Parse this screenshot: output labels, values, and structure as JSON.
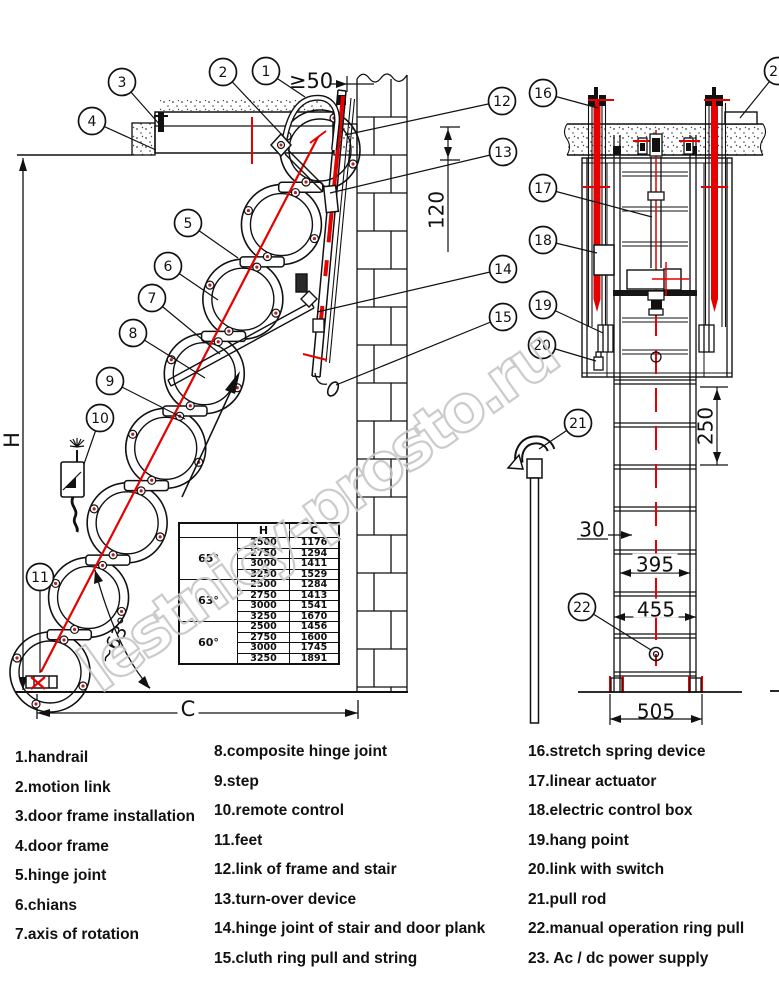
{
  "watermark": {
    "text": "lestnicy-prosto.ru"
  },
  "colors": {
    "red": "#e60000",
    "line": "#111111",
    "watermark": "#c6c6c6"
  },
  "table": {
    "headers": [
      "",
      "H",
      "C"
    ],
    "groups": [
      {
        "angle": "65°",
        "rows": [
          [
            "2500",
            "1176"
          ],
          [
            "2750",
            "1294"
          ],
          [
            "3000",
            "1411"
          ],
          [
            "3250",
            "1529"
          ]
        ]
      },
      {
        "angle": "63°",
        "rows": [
          [
            "2500",
            "1284"
          ],
          [
            "2750",
            "1413"
          ],
          [
            "3000",
            "1541"
          ],
          [
            "3250",
            "1670"
          ]
        ]
      },
      {
        "angle": "60°",
        "rows": [
          [
            "2500",
            "1456"
          ],
          [
            "2750",
            "1600"
          ],
          [
            "3000",
            "1745"
          ],
          [
            "3250",
            "1891"
          ]
        ]
      }
    ]
  },
  "legend": {
    "columns": [
      {
        "items": [
          "1.handrail",
          "2.motion link",
          "3.door frame installation",
          "4.door frame",
          "5.hinge joint",
          "6.chians",
          "7.axis of rotation"
        ]
      },
      {
        "items": [
          "8.composite hinge joint",
          "9.step",
          "10.remote control",
          "11.feet",
          "12.link of frame and stair",
          "13.turn-over device",
          "14.hinge joint of stair and door plank",
          "15.cluth ring pull and string"
        ]
      },
      {
        "items": [
          "16.stretch spring device",
          "17.linear actuator",
          "18.electric control box",
          "19.hang point",
          "20.link with switch",
          "21.pull rod",
          "22.manual operation ring pull",
          "23. Ac / dc power supply"
        ]
      }
    ]
  },
  "callouts": [
    {
      "n": "1",
      "cx": 266,
      "cy": 71,
      "tx": 305,
      "ty": 97
    },
    {
      "n": "2",
      "cx": 223,
      "cy": 72,
      "tx": 284,
      "ty": 137
    },
    {
      "n": "3",
      "cx": 122,
      "cy": 82,
      "tx": 161,
      "ty": 126
    },
    {
      "n": "4",
      "cx": 92,
      "cy": 121,
      "tx": 156,
      "ty": 150
    },
    {
      "n": "5",
      "cx": 188,
      "cy": 223,
      "tx": 238,
      "ty": 258
    },
    {
      "n": "6",
      "cx": 168,
      "cy": 266,
      "tx": 218,
      "ty": 300
    },
    {
      "n": "7",
      "cx": 152,
      "cy": 298,
      "tx": 220,
      "ty": 354
    },
    {
      "n": "8",
      "cx": 133,
      "cy": 333,
      "tx": 205,
      "ty": 378
    },
    {
      "n": "9",
      "cx": 110,
      "cy": 381,
      "tx": 185,
      "ty": 419
    },
    {
      "n": "10",
      "cx": 100,
      "cy": 418,
      "tx": 84,
      "ty": 464
    },
    {
      "n": "11",
      "cx": 40,
      "cy": 577,
      "tx": 40,
      "ty": 673
    },
    {
      "n": "12",
      "cx": 502,
      "cy": 101,
      "tx": 345,
      "ty": 135
    },
    {
      "n": "13",
      "cx": 503,
      "cy": 152,
      "tx": 330,
      "ty": 193
    },
    {
      "n": "14",
      "cx": 503,
      "cy": 269,
      "tx": 317,
      "ty": 312
    },
    {
      "n": "15",
      "cx": 503,
      "cy": 317,
      "tx": 336,
      "ty": 385
    },
    {
      "n": "16",
      "cx": 543,
      "cy": 93,
      "tx": 598,
      "ty": 108
    },
    {
      "n": "17",
      "cx": 543,
      "cy": 188,
      "tx": 652,
      "ty": 217
    },
    {
      "n": "18",
      "cx": 543,
      "cy": 240,
      "tx": 597,
      "ty": 253
    },
    {
      "n": "19",
      "cx": 543,
      "cy": 305,
      "tx": 603,
      "ty": 333
    },
    {
      "n": "20",
      "cx": 542,
      "cy": 345,
      "tx": 596,
      "ty": 361
    },
    {
      "n": "21",
      "cx": 578,
      "cy": 423,
      "tx": 539,
      "ty": 449
    },
    {
      "n": "22",
      "cx": 582,
      "cy": 607,
      "tx": 651,
      "ty": 650
    },
    {
      "n": "23",
      "cx": 778,
      "cy": 71,
      "tx": 740,
      "ty": 118
    }
  ],
  "dimensions": [
    {
      "label": "≥50",
      "x": 311,
      "y": 82,
      "rotate": 0,
      "size": 21,
      "bg": false
    },
    {
      "label": "120",
      "x": 438,
      "y": 210,
      "rotate": -90,
      "size": 20,
      "bg": false
    },
    {
      "label": "H",
      "x": 13,
      "y": 440,
      "rotate": -90,
      "size": 21,
      "bg": true
    },
    {
      "label": "C",
      "x": 188,
      "y": 710,
      "rotate": 0,
      "size": 21,
      "bg": true
    },
    {
      "label": "~63°",
      "x": 116,
      "y": 641,
      "rotate": -62,
      "size": 19,
      "bg": false
    },
    {
      "label": "250",
      "x": 707,
      "y": 426,
      "rotate": -90,
      "size": 20,
      "bg": false
    },
    {
      "label": "30",
      "x": 592,
      "y": 531,
      "rotate": 0,
      "size": 20,
      "bg": false
    },
    {
      "label": "395",
      "x": 655,
      "y": 566,
      "rotate": 0,
      "size": 20,
      "bg": true
    },
    {
      "label": "455",
      "x": 656,
      "y": 611,
      "rotate": 0,
      "size": 20,
      "bg": true
    },
    {
      "label": "505",
      "x": 656,
      "y": 713,
      "rotate": 0,
      "size": 20,
      "bg": false
    }
  ]
}
